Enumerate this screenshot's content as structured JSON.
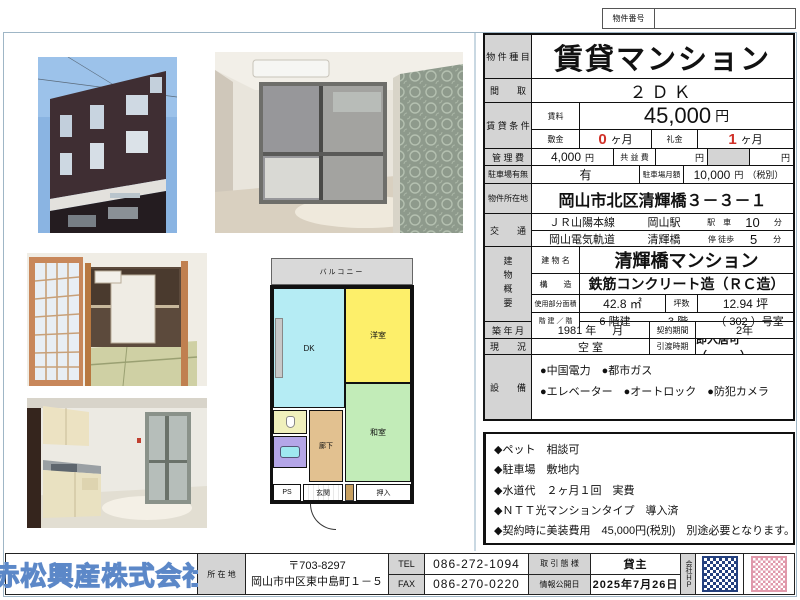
{
  "header": {
    "property_number_label": "物件番号",
    "property_number_value": ""
  },
  "units": {
    "yen": "円",
    "months": "ヶ月",
    "min": "分"
  },
  "main_table": {
    "type_label": "物 件 種 目",
    "type_value": "賃貸マンション",
    "layout_label": "間　　取",
    "layout_value": "２ＤＫ",
    "rent_section_label": "賃 貸 条 件",
    "rent_label": "賃料",
    "rent_value": "45,000",
    "deposit_label": "敷金",
    "deposit_value": "0",
    "key_label": "礼金",
    "key_value": "1",
    "mgmt_label": "管 理 費",
    "mgmt_value": "4,000",
    "kyoueki_label": "共 益 費",
    "parking_label": "駐車場有無",
    "parking_value": "有",
    "parking_fee_label": "駐車場月額",
    "parking_fee_value": "10,000",
    "parking_fee_tax": "（税別）",
    "address_label": "物件所在地",
    "address_value": "岡山市北区清輝橋３－３－１",
    "transport_label": "交　　通",
    "transport_rows": [
      {
        "line": "ＪＲ山陽本線",
        "station": "岡山駅",
        "mode": "駅　車",
        "time": "10"
      },
      {
        "line": "岡山電気軌道",
        "station": "清輝橋",
        "mode": "停 徒歩",
        "time": "5"
      }
    ],
    "building_label": "建物概要",
    "bname_label": "建 物 名",
    "bname_value": "清輝橋マンション",
    "structure_label": "構　　造",
    "structure_value": "鉄筋コンクリート造（ＲＣ造）",
    "area_label": "使用部分面積",
    "area_value": "42.8 ㎡",
    "tsubo_label": "坪数",
    "tsubo_value": "12.94 坪",
    "floors_label": "階 建 ／ 階",
    "floors_total": "6 階建",
    "floor_value": "3 階",
    "room_value": "（ 302 ）号室",
    "built_label": "築 年 月",
    "built_year": "1981 年",
    "built_month": "月",
    "contract_label": "契約期間",
    "contract_value": "2年",
    "status_label": "現　　況",
    "status_value": "空 室",
    "handover_label": "引渡時期",
    "handover_value": "即入居可　（　　　）",
    "equip_label": "設　　備",
    "equip_lines": [
      "●中国電力　●都市ガス",
      "●エレベーター　●オートロック　●防犯カメラ"
    ]
  },
  "notes": {
    "label": "備　　考",
    "lines": [
      "◆ペット　相談可",
      "◆駐車場　敷地内",
      "◆水道代　２ヶ月１回　実費",
      "◆ＮＴＴ光マンションタイプ　導入済",
      "◆契約時に美装費用　45,000円(税別)　別途必要となります。"
    ]
  },
  "floorplan": {
    "balcony": "バルコニー",
    "dk": "DK",
    "western_room": "洋室",
    "japanese_room": "和室",
    "hallway": "廊下",
    "ps": "PS",
    "entrance": "玄関",
    "closet": "押入"
  },
  "footer": {
    "company": "赤松興産株式会社",
    "location_label": "所 在 地",
    "postal": "〒703-8297",
    "address": "岡山市中区東中島町１－５",
    "tel_label": "TEL",
    "tel": "086-272-1094",
    "fax_label": "FAX",
    "fax": "086-270-0220",
    "deal_label": "取 引 態 様",
    "deal_value": "貸主",
    "date_label": "情報公開日",
    "date_value": "2025年7月26日",
    "hp_label": "会社ＨＰ"
  },
  "colors": {
    "accent_red": "#d03028",
    "company_blue": "#5c88c8",
    "label_gray": "#d4d4d4",
    "floorplan": {
      "balcony": "#d9d9d9",
      "dk": "#b5ecf4",
      "western_room": "#fdef6a",
      "japanese_room": "#c2ecb8",
      "hallway": "#e2c190",
      "toilet": "#f0f0bc",
      "bath": "#b4a6e8"
    }
  }
}
